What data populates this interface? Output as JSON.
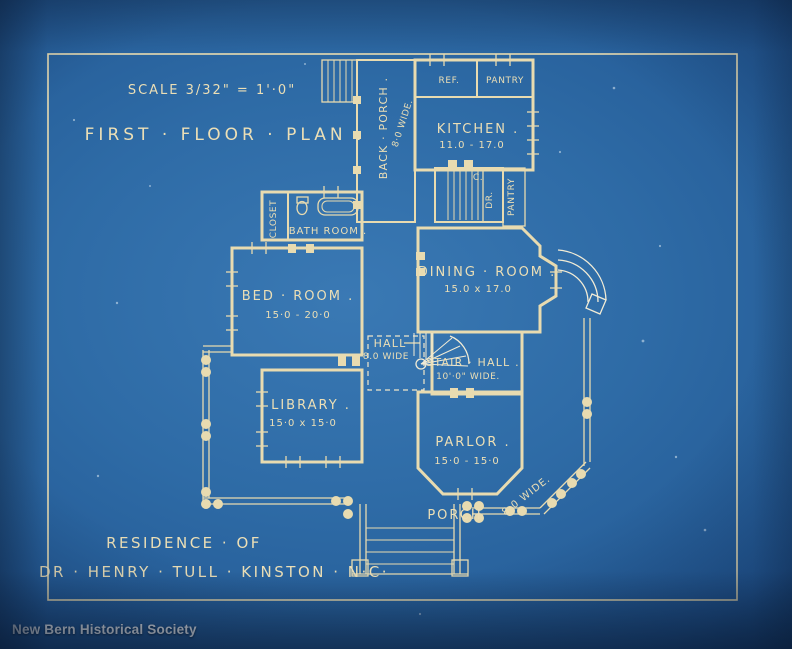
{
  "credit": "New Bern Historical Society",
  "colors": {
    "paper_blue": "#2e6ba6",
    "ink_cream": "#e8dbb0"
  },
  "title_block": {
    "scale_label": "SCALE 3/32\" = 1'·0\"",
    "plan_title": "FIRST · FLOOR · PLAN ."
  },
  "signature": {
    "line1": "RESIDENCE · OF",
    "line2": "DR · HENRY · TULL · KINSTON · N·C·"
  },
  "rooms": {
    "back_porch": {
      "name": "BACK · PORCH .",
      "dim": "8·0 WIDE."
    },
    "kitchen": {
      "name": "KITCHEN .",
      "dim": "11.0 - 17.0"
    },
    "ref": {
      "name": "REF."
    },
    "pantry_top": {
      "name": "PANTRY"
    },
    "closet_c": {
      "name": "C."
    },
    "dr": {
      "name": "DR."
    },
    "pantry_side": {
      "name": "PANTRY"
    },
    "closet": {
      "name": "CLOSET"
    },
    "bath_room": {
      "name": "BATH ROOM ."
    },
    "bed_room": {
      "name": "BED · ROOM .",
      "dim": "15·0 - 20·0"
    },
    "dining_room": {
      "name": "DINING · ROOM .",
      "dim": "15.0 x 17.0"
    },
    "hall": {
      "name": "HALL",
      "dim": "8.0 WIDE"
    },
    "stair_hall": {
      "name": "STAIR · HALL .",
      "dim": "10'·0\" WIDE."
    },
    "library": {
      "name": "LIBRARY .",
      "dim": "15·0 x 15·0"
    },
    "parlor": {
      "name": "PARLOR .",
      "dim": "15·0 - 15·0"
    },
    "porch": {
      "name": "PORCH",
      "dim": "8·0 WIDE."
    }
  }
}
